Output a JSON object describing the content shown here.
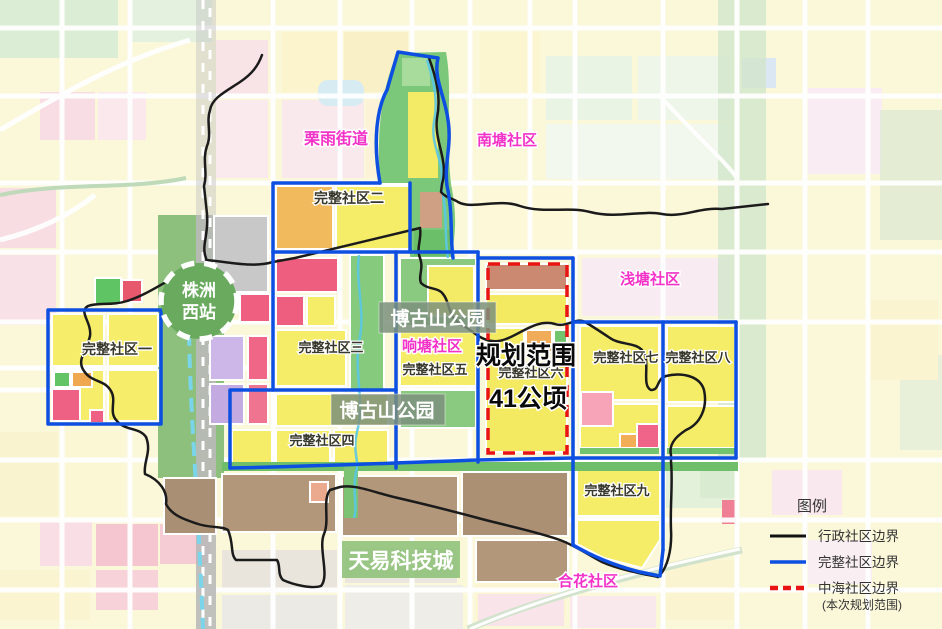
{
  "map": {
    "station": {
      "line1": "株洲",
      "line2": "西站"
    },
    "districts": {
      "liyu": "栗雨街道",
      "nantang": "南塘社区",
      "qiantang": "浅塘社区",
      "xiangtang": "响塘社区",
      "hehua": "合花社区"
    },
    "communities": {
      "c1": "完整社区一",
      "c2": "完整社区二",
      "c3": "完整社区三",
      "c4": "完整社区四",
      "c5": "完整社区五",
      "c6": "完整社区六",
      "c7": "完整社区七",
      "c8": "完整社区八",
      "c9": "完整社区九"
    },
    "parks": {
      "upper": "博古山公园",
      "lower": "博古山公园"
    },
    "tech_city": "天易科技城",
    "planning": {
      "scope": "规划范围",
      "area": "41公顷"
    }
  },
  "legend": {
    "title": "图例",
    "items": [
      {
        "label": "行政社区边界",
        "line_style": "solid",
        "color": "#111111"
      },
      {
        "label": "完整社区边界",
        "line_style": "solid",
        "color": "#0d4fe0"
      },
      {
        "label": "中海社区边界",
        "sublabel": "(本次规划范围)",
        "line_style": "dashed",
        "color": "#e81414"
      }
    ]
  },
  "colors": {
    "admin_boundary": "#1b1b1b",
    "community_boundary": "#0d4fe0",
    "planning_boundary": "#e81414",
    "district_label": "#f332c8",
    "park_label_bg": "#7d917d",
    "tech_label_bg": "#93c37d"
  }
}
